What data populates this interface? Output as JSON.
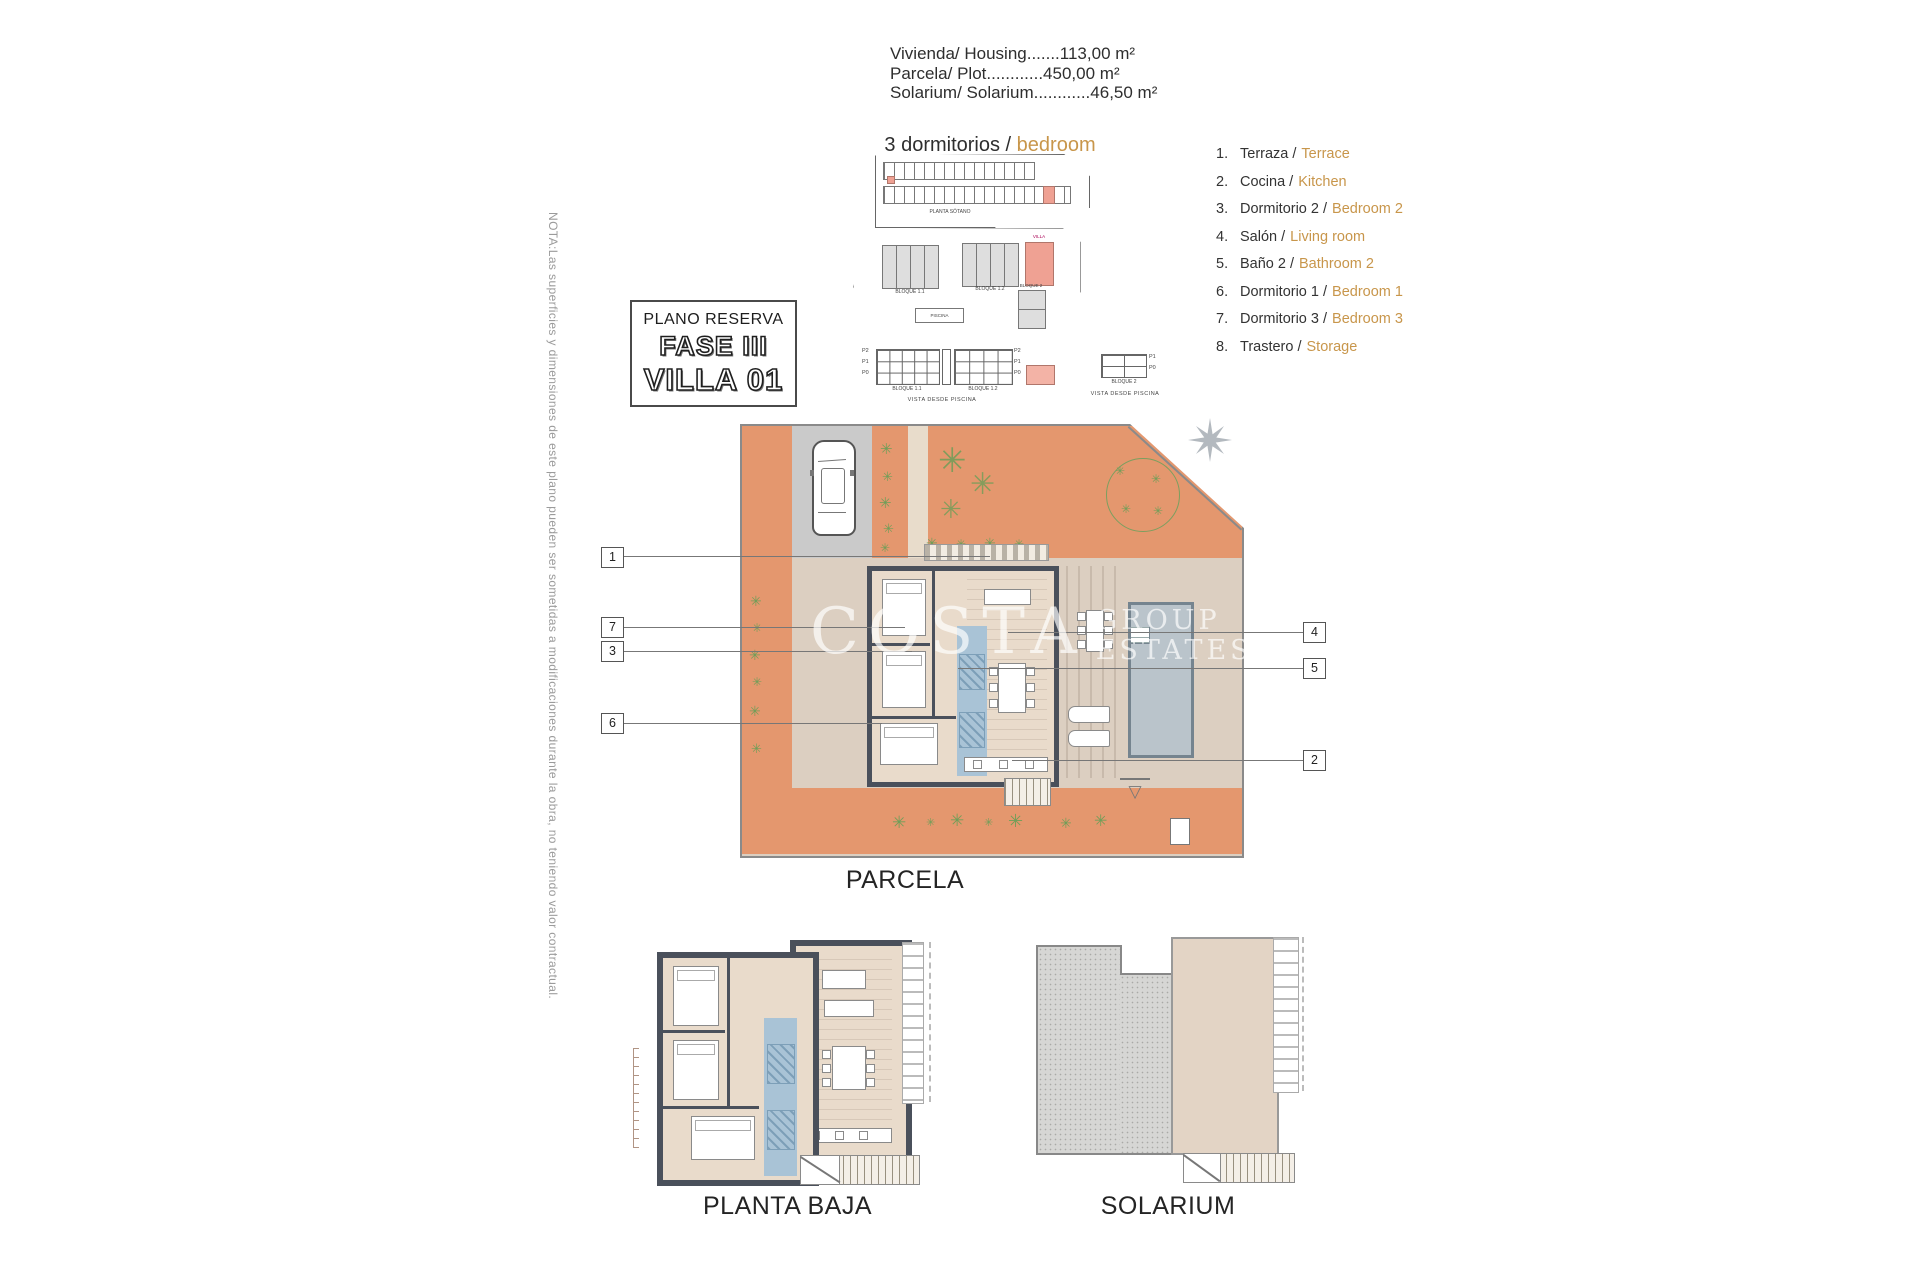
{
  "sheet": {
    "note": "NOTA:Las superficies y dimensiones de este plano pueden ser sometidas a modificaciones durante la obra, no teniendo valor contractual.",
    "specs": [
      "Vivienda/ Housing.......113,00 m²",
      "Parcela/ Plot............450,00 m²",
      "Solarium/ Solarium............46,50 m²"
    ],
    "type_label": {
      "es": "3 dormitorios /",
      "en": "bedroom"
    },
    "reserva": {
      "title": "PLANO RESERVA",
      "phase": "FASE III",
      "villa": "VILLA 01"
    },
    "captions": {
      "parcela": "PARCELA",
      "planta_baja": "PLANTA BAJA",
      "solarium": "SOLARIUM"
    },
    "watermark": {
      "w1": "COSTA",
      "w2": "GROUP",
      "w3": "ESTATES"
    }
  },
  "keyplans": {
    "basement_caption": "PLANTA SÓTANO",
    "site": {
      "bloque11": "BLOQUE 1.1",
      "bloque12": "BLOQUE 1.2",
      "villa": "VILLA",
      "bloque2": "BLOQUE 2",
      "piscina": "PISCINA"
    },
    "elev": {
      "rows_left": [
        "P2",
        "P1",
        "P0"
      ],
      "rows_right": [
        "P2",
        "P1",
        "P0"
      ],
      "rows_b2": [
        "P1",
        "P0"
      ],
      "bloque11": "BLOQUE 1.1",
      "bloque12": "BLOQUE 1.2",
      "bloque2": "BLOQUE 2",
      "vista1": "VISTA DESDE PISCINA",
      "vista2": "VISTA DESDE PISCINA"
    }
  },
  "legend": {
    "items": [
      {
        "num": "1.",
        "es": "Terraza /",
        "en": "Terrace"
      },
      {
        "num": "2.",
        "es": "Cocina /",
        "en": "Kitchen"
      },
      {
        "num": "3.",
        "es": "Dormitorio 2 /",
        "en": "Bedroom 2"
      },
      {
        "num": "4.",
        "es": "Salón /",
        "en": "Living room"
      },
      {
        "num": "5.",
        "es": "Baño 2 /",
        "en": "Bathroom 2"
      },
      {
        "num": "6.",
        "es": "Dormitorio 1 /",
        "en": "Bedroom 1"
      },
      {
        "num": "7.",
        "es": "Dormitorio 3 /",
        "en": "Bedroom 3"
      },
      {
        "num": "8.",
        "es": "Trastero /",
        "en": "Storage"
      }
    ]
  },
  "callouts": {
    "left": [
      "1",
      "7",
      "3",
      "6"
    ],
    "right": [
      "4",
      "5",
      "2"
    ]
  },
  "colors": {
    "accent_orange_text": "#c8964b",
    "terrace_orange": "#e4976e",
    "interior_beige": "#e9dbcb",
    "bath_blue": "#a9c3d6",
    "wall_dark": "#4a505b",
    "pool_gray": "#bac4cb",
    "highlight_pink": "#efa193",
    "plant_green": "#6f9e58",
    "driveway_gray": "#cacaca"
  }
}
